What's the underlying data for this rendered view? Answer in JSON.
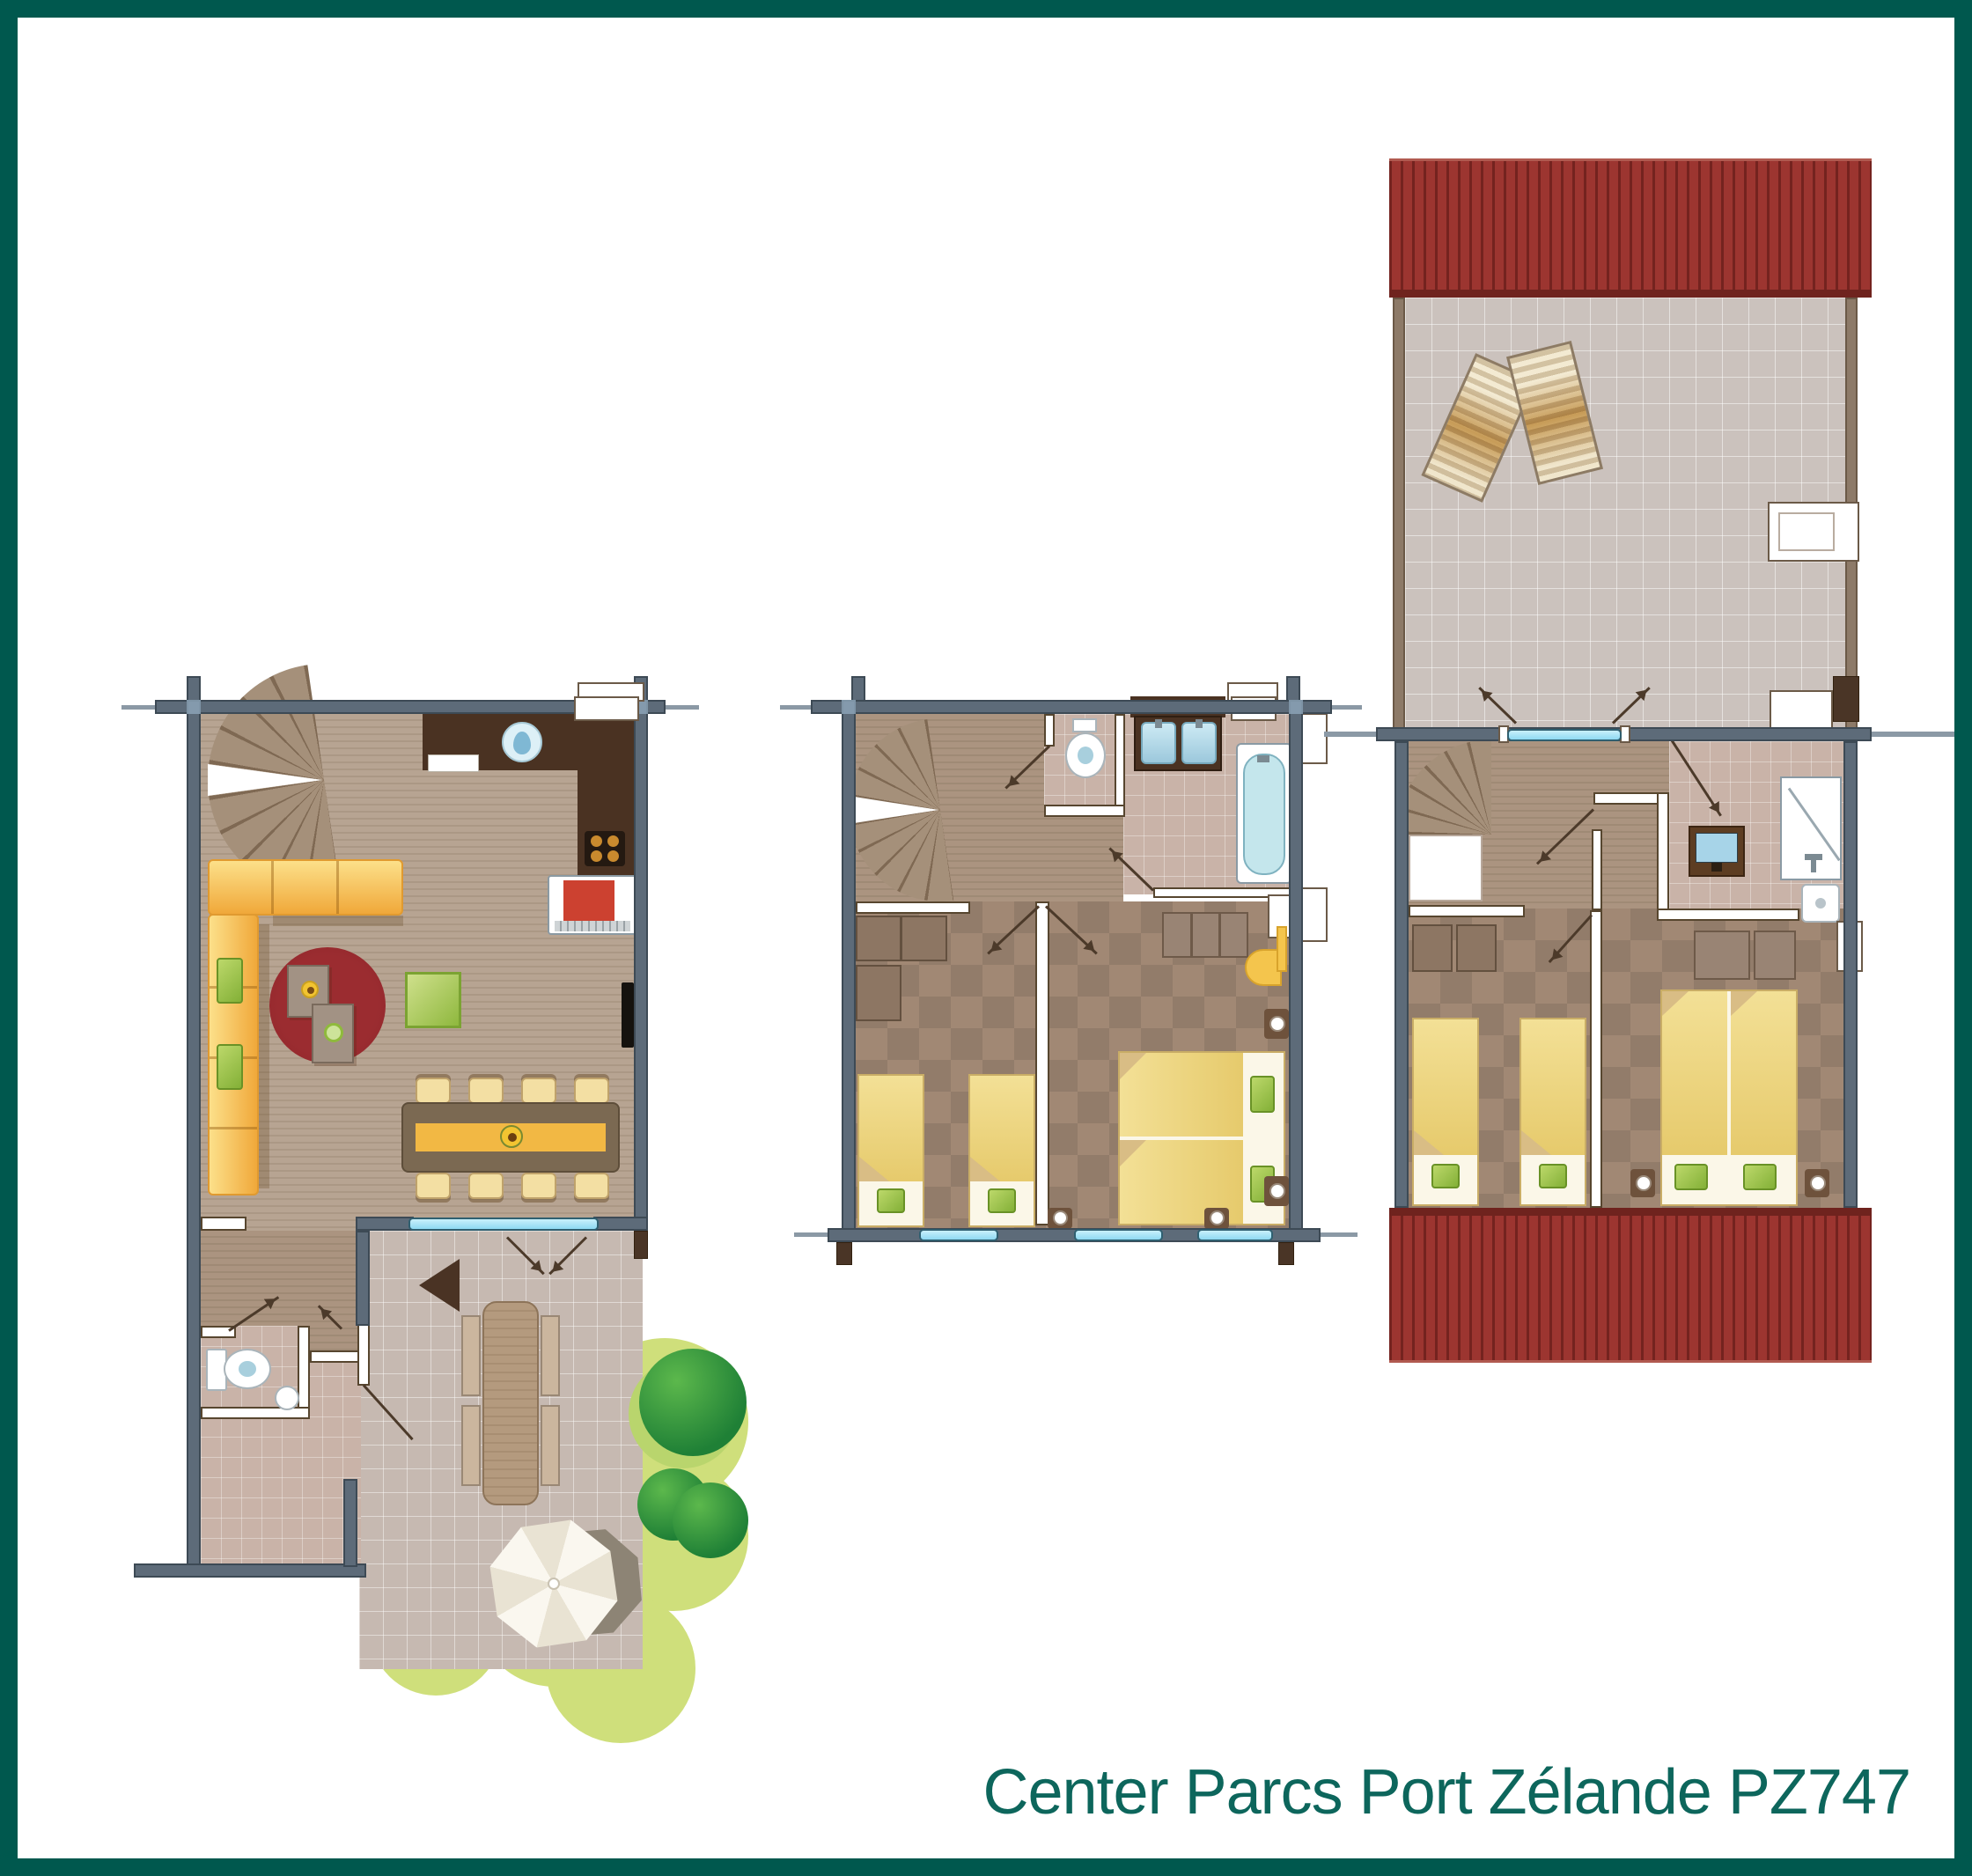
{
  "caption": "Center Parcs Port Zélande PZ747",
  "colors": {
    "border": "#00584e",
    "caption": "#0d665c",
    "wall": "#5d6b79",
    "wallEdge": "#3d4a55",
    "wwEdge": "#57462f",
    "doorLine": "#4c3a2a",
    "glass": "#8ed9f2",
    "roof": "#9c3530",
    "lawn": "#cfdf7b",
    "bushDark": "#1f8036",
    "bushLight": "#5cb84c",
    "rug": "#8e262b",
    "counter": "#4a3222",
    "oven": "#cc4130",
    "runner": "#f2b844",
    "tub": "#c4e6ec",
    "tv_screen": "#a7d4e8"
  }
}
